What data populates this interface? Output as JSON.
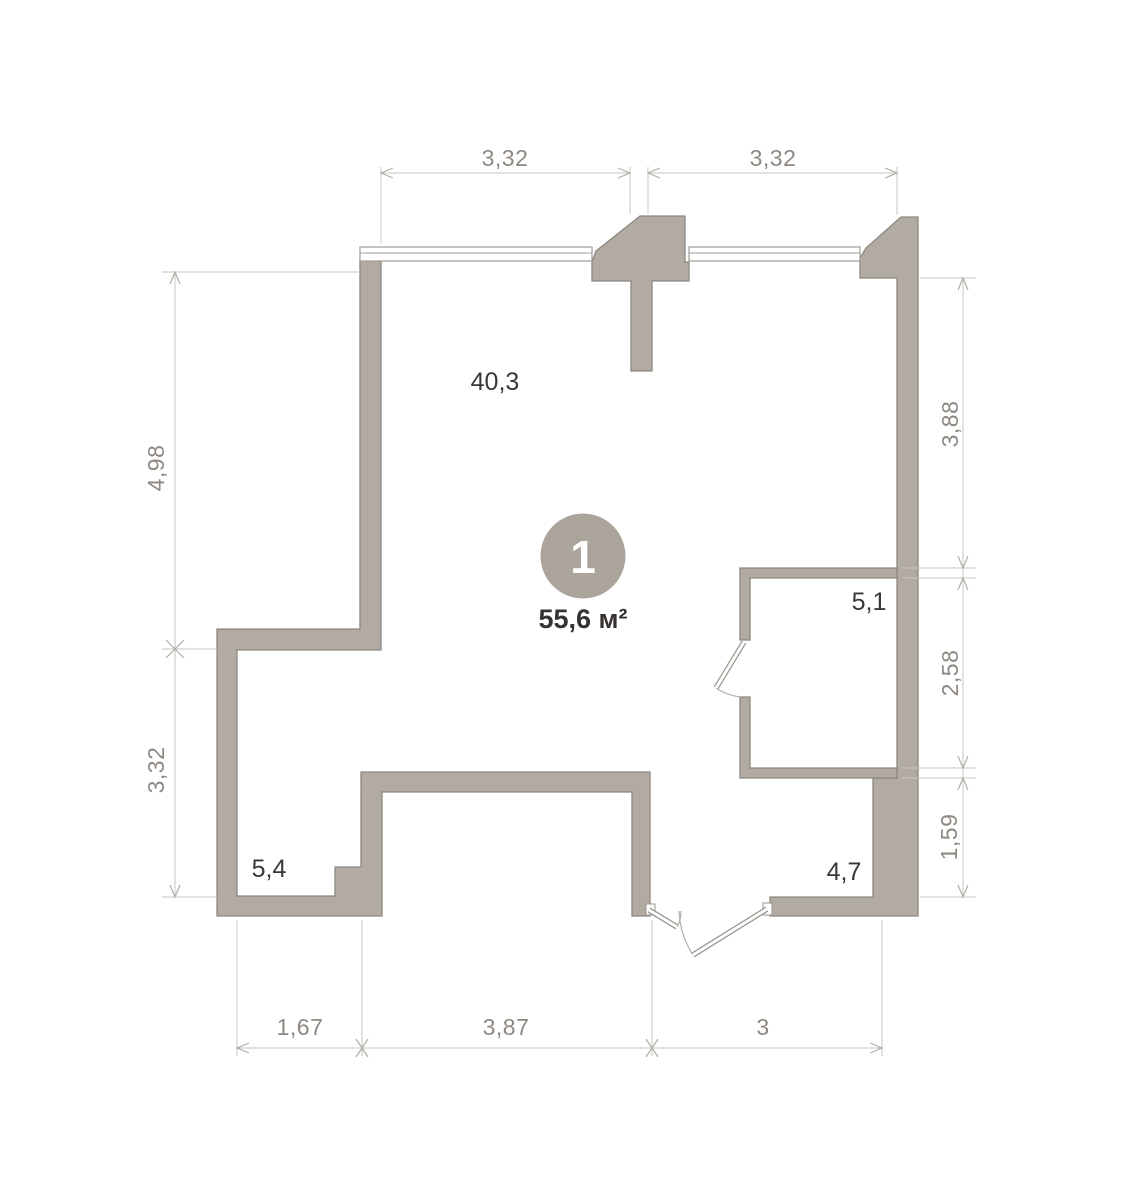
{
  "plan": {
    "unit": {
      "number": "1",
      "area": "55,6 м²"
    },
    "room_areas": {
      "main": "40,3",
      "right": "5,1",
      "bottom_left": "5,4",
      "bottom_right": "4,7"
    },
    "dimensions": {
      "top": [
        "3,32",
        "3,32"
      ],
      "left": [
        "4,98",
        "3,32"
      ],
      "right": [
        "3,88",
        "2,58",
        "1,59"
      ],
      "bottom": [
        "1,67",
        "3,87",
        "3"
      ]
    },
    "colors": {
      "wall_fill": "#b2aba4",
      "wall_stroke": "#8d8780",
      "dimension_line": "#c8c4be",
      "dimension_text": "#8e8881",
      "room_label_text": "#3b3834",
      "unit_circle_fill": "#aba49c",
      "unit_number_text": "#ffffff",
      "background": "#ffffff"
    }
  }
}
